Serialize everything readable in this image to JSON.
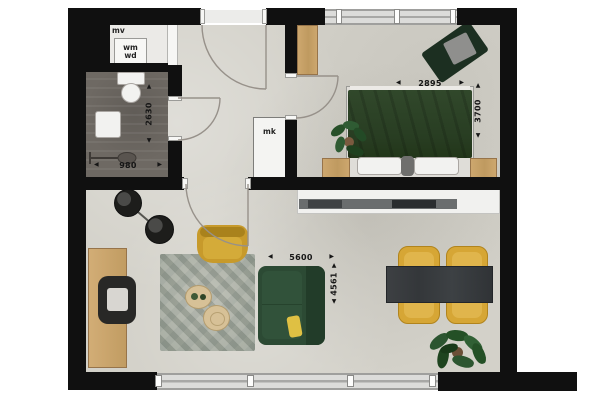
{
  "floorplan": {
    "type": "apartment-floor-plan-top-view",
    "labels": {
      "mechanical_ventilation": "mv",
      "washer": "wm",
      "dryer": "wd",
      "meter_cupboard": "mk"
    },
    "dimensions_mm": {
      "bathroom_width": "980",
      "bathroom_depth": "2630",
      "bedroom_width": "2895",
      "bedroom_depth": "3700",
      "living_room_width": "5600",
      "living_room_depth": "4561"
    },
    "arrows": {
      "left": "◀",
      "right": "▶",
      "up": "▲",
      "down": "▼"
    },
    "colors": {
      "wall": "#101010",
      "concrete_floor": "#d3d1c9",
      "bathroom_floor": "#6e6963",
      "wood": "#c9a363",
      "bed_green": "#2e4428",
      "sofa_green": "#2c4a34",
      "mustard": "#d6a635",
      "table_charcoal": "#3a3d40",
      "plant_green": "#2c5530"
    }
  }
}
